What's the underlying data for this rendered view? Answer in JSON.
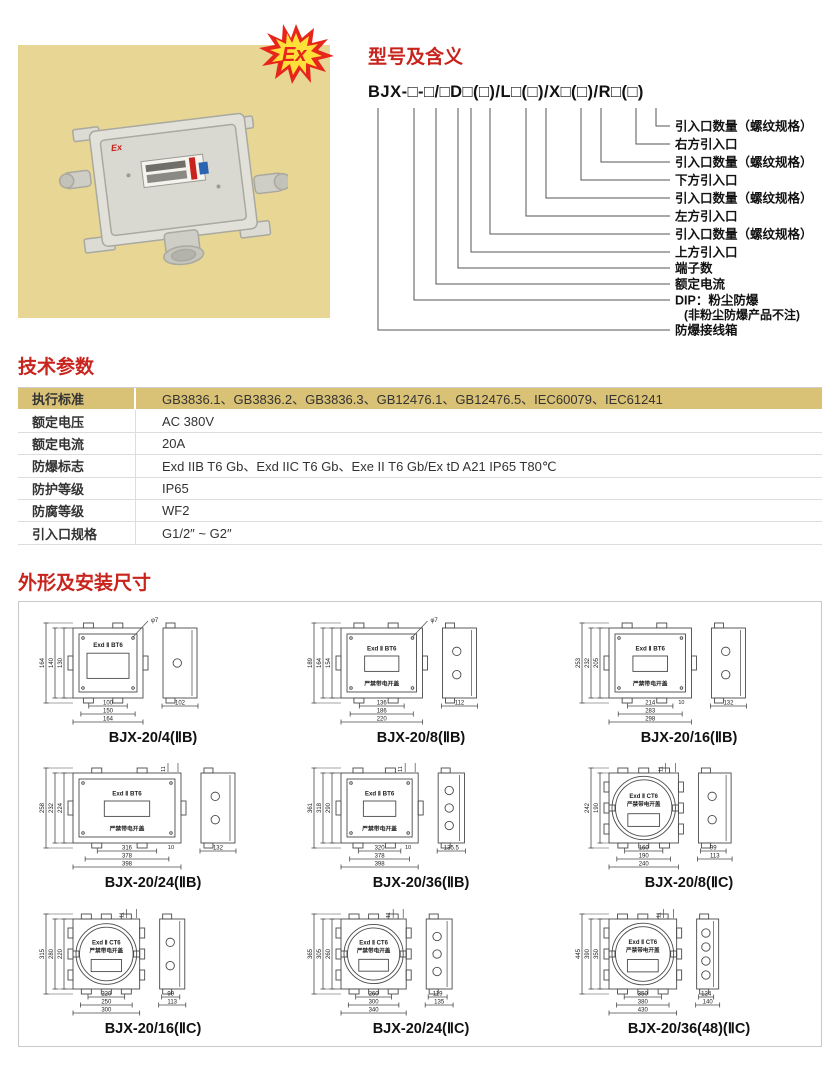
{
  "photo": {
    "ex_badge": "Ex",
    "box_mark": "Ex"
  },
  "model_section": {
    "title": "型号及含义",
    "model": "BJX-□-□/□D□(□)/L□(□)/X□(□)/R□(□)",
    "labels": [
      {
        "text": "引入口数量（螺纹规格）"
      },
      {
        "text": "右方引入口"
      },
      {
        "text": "引入口数量（螺纹规格）"
      },
      {
        "text": "下方引入口"
      },
      {
        "text": "引入口数量（螺纹规格）"
      },
      {
        "text": "左方引入口"
      },
      {
        "text": "引入口数量（螺纹规格）"
      },
      {
        "text": "上方引入口"
      },
      {
        "text": "端子数"
      },
      {
        "text": "额定电流"
      },
      {
        "text": "DIP：粉尘防爆",
        "text2": "(非粉尘防爆产品不注)"
      },
      {
        "text": "防爆接线箱"
      }
    ]
  },
  "params_section": {
    "title": "技术参数",
    "rows": [
      {
        "label": "执行标准",
        "value": "GB3836.1、GB3836.2、GB3836.3、GB12476.1、GB12476.5、IEC60079、IEC61241",
        "highlight": true
      },
      {
        "label": "额定电压",
        "value": "AC 380V",
        "highlight": false
      },
      {
        "label": "额定电流",
        "value": "20A",
        "highlight": false
      },
      {
        "label": "防爆标志",
        "value": "Exd IIB T6 Gb、Exd IIC T6 Gb、Exe II T6 Gb/Ex tD A21 IP65 T80℃",
        "highlight": false
      },
      {
        "label": "防护等级",
        "value": "IP65",
        "highlight": false
      },
      {
        "label": "防腐等级",
        "value": "WF2",
        "highlight": false
      },
      {
        "label": "引入口规格",
        "value": "G1/2″ ~ G2″",
        "highlight": false
      }
    ]
  },
  "dims_section": {
    "title": "外形及安装尺寸",
    "drawings": [
      {
        "caption": "BJX-20/4(ⅡB)",
        "style": "rect",
        "face1": "Exd Ⅱ BT6",
        "face2": null,
        "v_dims": [
          "164",
          "140",
          "130"
        ],
        "h_dims": [
          "100",
          "150",
          "164"
        ],
        "side_dims": [
          "102"
        ],
        "holes": 1,
        "top_note": "φ7",
        "offset_dim": null
      },
      {
        "caption": "BJX-20/8(ⅡB)",
        "style": "rect",
        "face1": "Exd Ⅱ BT6",
        "face2": "严禁带电开盖",
        "v_dims": [
          "189",
          "164",
          "154"
        ],
        "h_dims": [
          "136",
          "186",
          "220"
        ],
        "side_dims": [
          "112"
        ],
        "holes": 2,
        "top_note": "φ7",
        "offset_dim": null
      },
      {
        "caption": "BJX-20/16(ⅡB)",
        "style": "rect",
        "face1": "Exd Ⅱ BT6",
        "face2": "严禁带电开盖",
        "v_dims": [
          "253",
          "232",
          "205"
        ],
        "h_dims": [
          "214",
          "283",
          "298"
        ],
        "side_dims": [
          "132"
        ],
        "holes": 2,
        "top_note": null,
        "offset_dim": "10"
      },
      {
        "caption": "BJX-20/24(ⅡB)",
        "style": "rect",
        "face1": "Exd Ⅱ BT6",
        "face2": "严禁带电开盖",
        "v_dims": [
          "258",
          "232",
          "224"
        ],
        "h_dims": [
          "316",
          "378",
          "398"
        ],
        "side_dims": [
          "132"
        ],
        "holes": 2,
        "top_note": "11",
        "offset_dim": "10"
      },
      {
        "caption": "BJX-20/36(ⅡB)",
        "style": "rect",
        "face1": "Exd Ⅱ BT6",
        "face2": "严禁带电开盖",
        "v_dims": [
          "361",
          "318",
          "290"
        ],
        "h_dims": [
          "320",
          "378",
          "398"
        ],
        "side_dims": [
          "135.5"
        ],
        "holes": 3,
        "top_note": "11",
        "offset_dim": "10"
      },
      {
        "caption": "BJX-20/8(ⅡC)",
        "style": "round",
        "face1": "Exd Ⅱ CT6",
        "face2": "严禁带电开盖",
        "v_dims": [
          "242",
          "190"
        ],
        "h_dims": [
          "160",
          "190",
          "240"
        ],
        "side_dims": [
          "99",
          "113"
        ],
        "holes": 2,
        "top_note": "11",
        "offset_dim": null
      },
      {
        "caption": "BJX-20/16(ⅡC)",
        "style": "round",
        "face1": "Exd Ⅱ CT6",
        "face2": "严禁带电开盖",
        "v_dims": [
          "315",
          "280",
          "220"
        ],
        "h_dims": [
          "220",
          "250",
          "300"
        ],
        "side_dims": [
          "99",
          "113"
        ],
        "holes": 2,
        "top_note": "11",
        "offset_dim": null
      },
      {
        "caption": "BJX-20/24(ⅡC)",
        "style": "round",
        "face1": "Exd Ⅱ CT6",
        "face2": "严禁带电开盖",
        "v_dims": [
          "365",
          "305",
          "260"
        ],
        "h_dims": [
          "260",
          "300",
          "340"
        ],
        "side_dims": [
          "119",
          "135"
        ],
        "holes": 3,
        "top_note": "11",
        "offset_dim": null
      },
      {
        "caption": "BJX-20/36(48)(ⅡC)",
        "style": "round",
        "face1": "Exd Ⅱ CT6",
        "face2": "严禁带电开盖",
        "v_dims": [
          "445",
          "390",
          "350"
        ],
        "h_dims": [
          "350",
          "380",
          "430"
        ],
        "side_dims": [
          "124",
          "140"
        ],
        "holes": 4,
        "top_note": "11",
        "offset_dim": null
      }
    ]
  },
  "colors": {
    "accent_red": "#c8231c",
    "photo_khaki": "#e7d694",
    "table_khaki": "#d9c175",
    "line_gray": "#555555"
  }
}
